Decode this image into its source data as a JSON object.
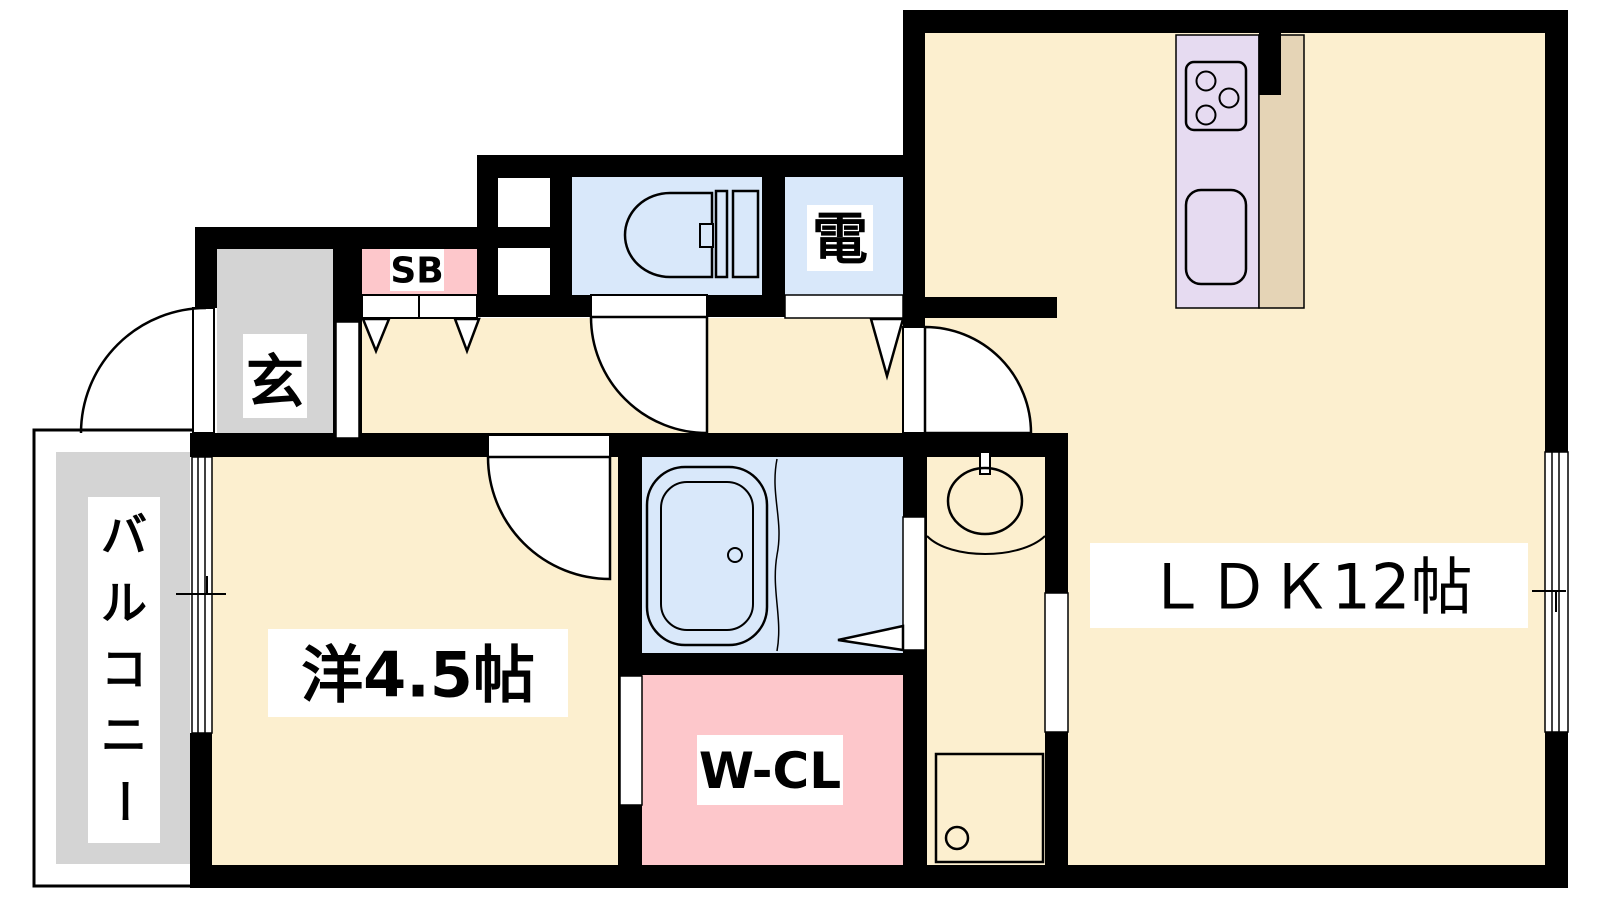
{
  "plan": {
    "type": "apartment-floor-plan",
    "rooms": {
      "ldk": {
        "label": "ＬＤＫ12帖"
      },
      "western_room": {
        "label": "洋4.5帖"
      },
      "walk_in_closet": {
        "label": "W-CL"
      },
      "entrance": {
        "label": "玄"
      },
      "shoe_box": {
        "label": "SB"
      },
      "electric": {
        "label": "電"
      },
      "balcony": {
        "label": "バルコニー",
        "chars": [
          "バ",
          "ル",
          "コ",
          "ニ",
          "ー"
        ]
      }
    },
    "colors": {
      "wall": "#000000",
      "wood_floor": "#FCEFCF",
      "tile_gray": "#D4D4D4",
      "water_blue": "#D9E8FA",
      "closet_pink": "#FDC7CB",
      "kitchen_lavender": "#E6DBF1",
      "counter_tan": "#E5D4B6",
      "background": "#FFFFFF"
    }
  }
}
